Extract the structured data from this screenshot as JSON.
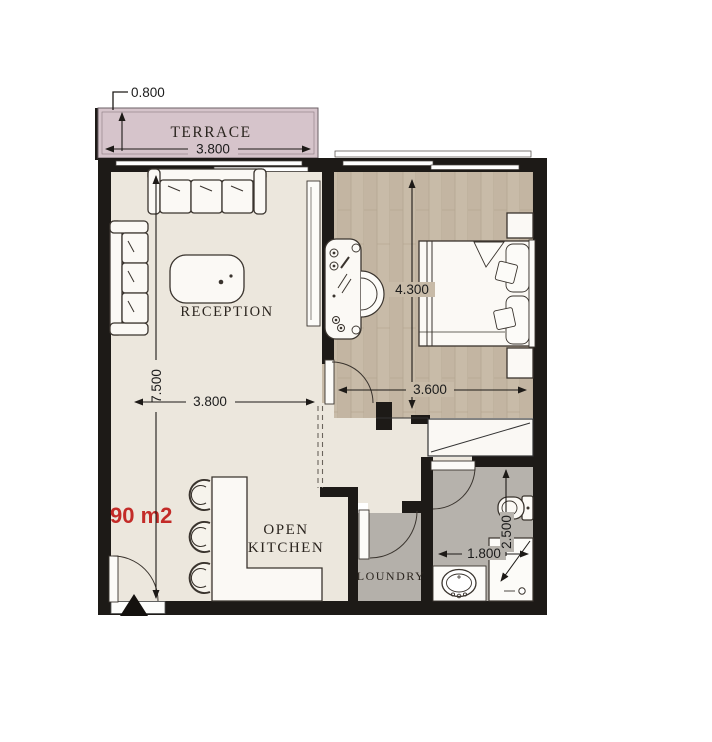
{
  "plan": {
    "area_label": "90 m2",
    "terrace": {
      "label": "TERRACE",
      "width_dim": "3.800",
      "depth_dim": "0.800"
    },
    "reception": {
      "label": "RECEPTION",
      "width_dim": "3.800",
      "length_dim": "7.500"
    },
    "bedroom": {
      "length_dim": "4.300",
      "width_dim": "3.600"
    },
    "kitchen": {
      "label_line1": "OPEN",
      "label_line2": "KITCHEN"
    },
    "laundry": {
      "label": "LOUNDRY"
    },
    "bathroom": {
      "width_dim": "1.800",
      "length_dim": "2.500"
    },
    "colors": {
      "wall": "#1d1a17",
      "terrace_fill": "#d6c4cb",
      "floor_main": "#ece7dd",
      "floor_bedroom": "#c8bba8",
      "floor_wet": "#b6b2ac",
      "area_text": "#c32b28",
      "furniture_outline": "#3a342e"
    }
  }
}
